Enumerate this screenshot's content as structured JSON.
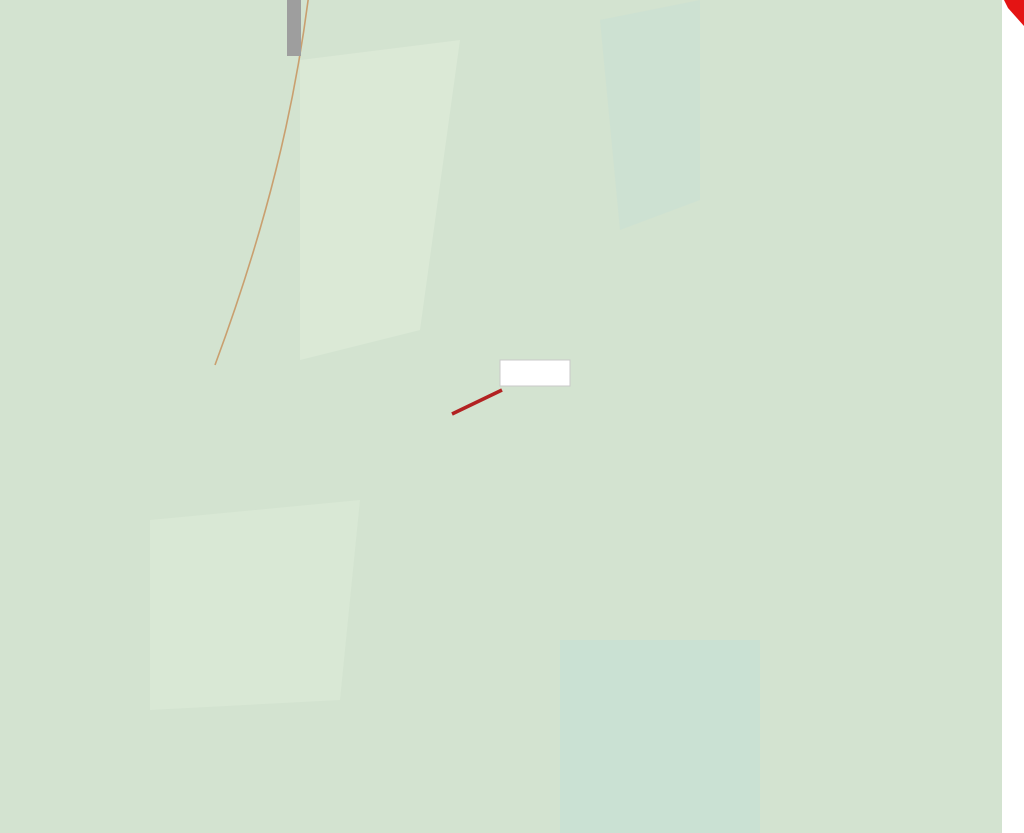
{
  "map": {
    "title": "cadastral-forestry-map",
    "colors": {
      "mint": "#d3e3d0",
      "mint_patch": "#dcead7",
      "mint_teal": "#c8e0d4",
      "contour": "#c99f6f",
      "contour_index": "#b07c4a",
      "pale_yellow": "#f6efbb",
      "bright_yellow": "#f6ee13",
      "red": "#e41414",
      "green": "#1fd11f",
      "brown": "#b5790d",
      "gray": "#8b8b8b",
      "purple": "#9c1fb5",
      "stream": "#5b9bd6",
      "hill_edge_green": "#2f8032",
      "leader_red": "#b22222",
      "box_text_red": "#c41111"
    },
    "parcel_box": {
      "text": "1589/2"
    },
    "watermark": {
      "small": "© ČÚZK",
      "large": "© ČÚZK"
    },
    "region_labels": [
      {
        "id": "a-topleft",
        "text": "a",
        "x": 23,
        "y": 128,
        "size": 62
      },
      {
        "id": "m",
        "text": "m",
        "x": 145,
        "y": 188,
        "size": 75
      },
      {
        "id": "three-under-m",
        "text": "3",
        "x": 144,
        "y": 268,
        "size": 71
      },
      {
        "id": "twob-top",
        "text": "2b",
        "x": 255,
        "y": 60,
        "size": 80
      },
      {
        "id": "l6",
        "text": "l6",
        "x": 273,
        "y": 187,
        "size": 76
      },
      {
        "id": "threeb",
        "text": "3b",
        "x": 38,
        "y": 363,
        "size": 64
      },
      {
        "id": "twob-mid",
        "text": "2b",
        "x": 167,
        "y": 473,
        "size": 62
      },
      {
        "id": "j3a",
        "text": "j3a",
        "x": 15,
        "y": 655,
        "size": 66,
        "anchor": "start"
      },
      {
        "id": "p315",
        "text": "315",
        "x": 533,
        "y": 330,
        "size": 158
      },
      {
        "id": "e-wedge",
        "text": "e",
        "x": 443,
        "y": 412,
        "size": 96
      },
      {
        "id": "d",
        "text": "d",
        "x": 369,
        "y": 512,
        "size": 80
      },
      {
        "id": "nine-wedge",
        "text": "9",
        "x": 411,
        "y": 518,
        "size": 62
      },
      {
        "id": "nine-leader",
        "text": "9",
        "x": 503,
        "y": 470,
        "size": 66
      },
      {
        "id": "zero",
        "text": "0",
        "x": 270,
        "y": 589,
        "size": 70
      },
      {
        "id": "B",
        "text": "B",
        "x": 450,
        "y": 660,
        "size": 128
      },
      {
        "id": "nine-band",
        "text": "9",
        "x": 202,
        "y": 797,
        "size": 75
      },
      {
        "id": "f-band",
        "text": "f",
        "x": 258,
        "y": 796,
        "size": 88
      },
      {
        "id": "e-gray",
        "text": "e",
        "x": 673,
        "y": 558,
        "size": 82
      },
      {
        "id": "eleven-gray",
        "text": "11",
        "x": 658,
        "y": 637,
        "size": 66
      },
      {
        "id": "g-gray",
        "text": "g",
        "x": 729,
        "y": 672,
        "size": 84
      },
      {
        "id": "eleven-leader",
        "text": "11",
        "x": 830,
        "y": 572,
        "size": 68
      },
      {
        "id": "b-right",
        "text": "b",
        "x": 886,
        "y": 693,
        "size": 84
      },
      {
        "id": "ten",
        "text": "10",
        "x": 877,
        "y": 773,
        "size": 86
      },
      {
        "id": "twelve-4",
        "text": "12/4",
        "x": 877,
        "y": 297,
        "size": 52
      },
      {
        "id": "a-striped",
        "text": "a",
        "x": 921,
        "y": 202,
        "size": 78
      },
      {
        "id": "three-topright",
        "text": "3",
        "x": 972,
        "y": 112,
        "size": 150,
        "rot": 20
      },
      {
        "id": "esh-1",
        "text": "∫",
        "x": 244,
        "y": 285,
        "size": 56,
        "rot": 15,
        "cls": "sym"
      },
      {
        "id": "esh-2",
        "text": "∫",
        "x": 210,
        "y": 330,
        "size": 46,
        "rot": 8,
        "cls": "sym"
      },
      {
        "id": "esh-3",
        "text": "∫",
        "x": 405,
        "y": 470,
        "size": 40,
        "cls": "sym"
      },
      {
        "id": "esh-4",
        "text": "∫",
        "x": 45,
        "y": 722,
        "size": 46,
        "rot": -8,
        "cls": "sym"
      },
      {
        "id": "esh-5",
        "text": "∫",
        "x": 22,
        "y": 492,
        "size": 46,
        "cls": "sym"
      },
      {
        "id": "arrow-left",
        "text": "<",
        "x": 196,
        "y": 302,
        "size": 56
      }
    ],
    "micro_marks": [
      {
        "sym": "theta",
        "x": 556,
        "y": 42,
        "num": "1580/2"
      },
      {
        "sym": "theta",
        "x": 612,
        "y": 176,
        "num": "1581"
      },
      {
        "sym": "theta",
        "x": 716,
        "y": 138,
        "num": "12/42"
      },
      {
        "sym": "theta",
        "x": 615,
        "y": 786,
        "num": "1580"
      },
      {
        "sym": "ctree",
        "x": 347,
        "y": 757,
        "num": "1582"
      },
      {
        "sym": "ctree",
        "x": 596,
        "y": 745,
        "num": "1585"
      },
      {
        "sym": "ctree",
        "x": 890,
        "y": 502,
        "num": "1584"
      },
      {
        "sym": "ctree",
        "x": 944,
        "y": 200,
        "num": "156"
      },
      {
        "sym": "ctree",
        "x": 932,
        "y": 108,
        "num": "1561"
      },
      {
        "sym": "ctree",
        "x": 140,
        "y": 758,
        "num": "157"
      },
      {
        "sym": "ctree",
        "x": 446,
        "y": 385,
        "num": ""
      },
      {
        "sym": "none",
        "x": 646,
        "y": 250,
        "num": "1584"
      },
      {
        "sym": "none",
        "x": 543,
        "y": 608,
        "num": "1585"
      }
    ],
    "trees": [
      {
        "type": "loop",
        "x": 510,
        "y": 42
      },
      {
        "type": "loop",
        "x": 483,
        "y": 228
      },
      {
        "type": "loop",
        "x": 608,
        "y": 370
      },
      {
        "type": "loop",
        "x": 252,
        "y": 636
      },
      {
        "type": "loop",
        "x": 688,
        "y": 778
      },
      {
        "type": "loop",
        "x": 752,
        "y": 128
      },
      {
        "type": "conifer",
        "x": 585,
        "y": 25
      }
    ]
  }
}
